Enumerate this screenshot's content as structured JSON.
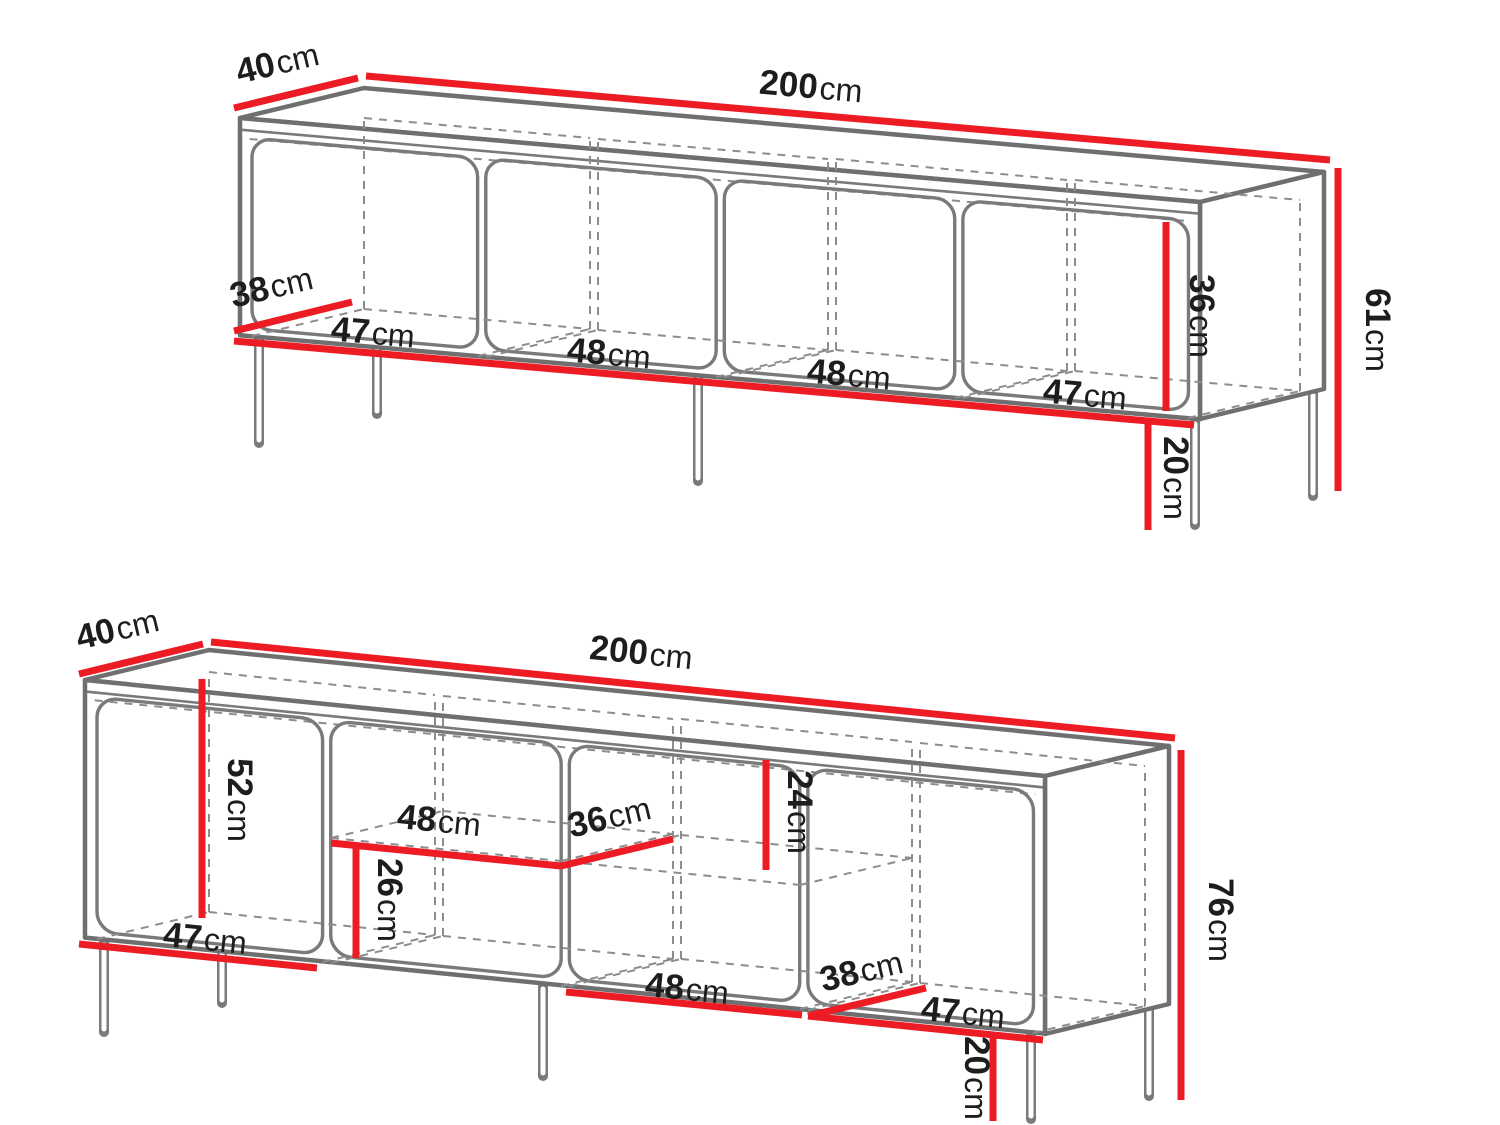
{
  "figure": {
    "title": "cabinet-dimension-diagram",
    "top_cabinet": {
      "width": {
        "value": "200",
        "unit": "cm"
      },
      "depth": {
        "value": "40",
        "unit": "cm"
      },
      "total_height": {
        "value": "61",
        "unit": "cm"
      },
      "leg_height": {
        "value": "20",
        "unit": "cm"
      },
      "interior_depth": {
        "value": "38",
        "unit": "cm"
      },
      "interior_height": {
        "value": "36",
        "unit": "cm"
      },
      "compartments": [
        {
          "value": "47",
          "unit": "cm"
        },
        {
          "value": "48",
          "unit": "cm"
        },
        {
          "value": "48",
          "unit": "cm"
        },
        {
          "value": "47",
          "unit": "cm"
        }
      ]
    },
    "bottom_cabinet": {
      "width": {
        "value": "200",
        "unit": "cm"
      },
      "depth": {
        "value": "40",
        "unit": "cm"
      },
      "total_height": {
        "value": "76",
        "unit": "cm"
      },
      "leg_height": {
        "value": "20",
        "unit": "cm"
      },
      "interior_height": {
        "value": "52",
        "unit": "cm"
      },
      "compartment1_width": {
        "value": "47",
        "unit": "cm"
      },
      "compartment3_width": {
        "value": "48",
        "unit": "cm"
      },
      "compartment4_width": {
        "value": "47",
        "unit": "cm"
      },
      "compartment4_depth": {
        "value": "38",
        "unit": "cm"
      },
      "shelf_width": {
        "value": "48",
        "unit": "cm"
      },
      "shelf_depth": {
        "value": "36",
        "unit": "cm"
      },
      "above_shelf_height": {
        "value": "24",
        "unit": "cm"
      },
      "below_shelf_height": {
        "value": "26",
        "unit": "cm"
      }
    }
  }
}
